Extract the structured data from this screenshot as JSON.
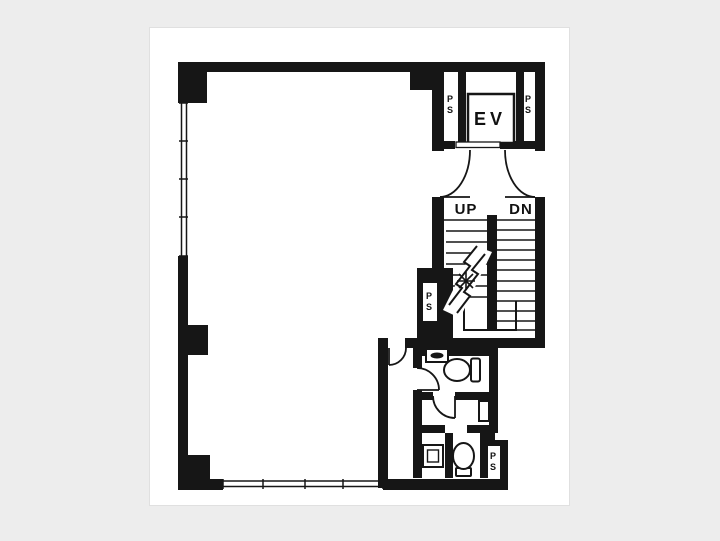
{
  "colors": {
    "background": "#ededed",
    "paper": "#ffffff",
    "ink": "#161616"
  },
  "plan": {
    "elevator": {
      "label": "EV"
    },
    "stairs": {
      "up_label": "UP",
      "down_label": "DN"
    },
    "pipe_shafts": [
      {
        "id": "elevator-left",
        "label": "PS"
      },
      {
        "id": "elevator-right",
        "label": "PS"
      },
      {
        "id": "stairs-left",
        "label": "PS"
      },
      {
        "id": "restroom-bottom",
        "label": "PS"
      }
    ]
  }
}
